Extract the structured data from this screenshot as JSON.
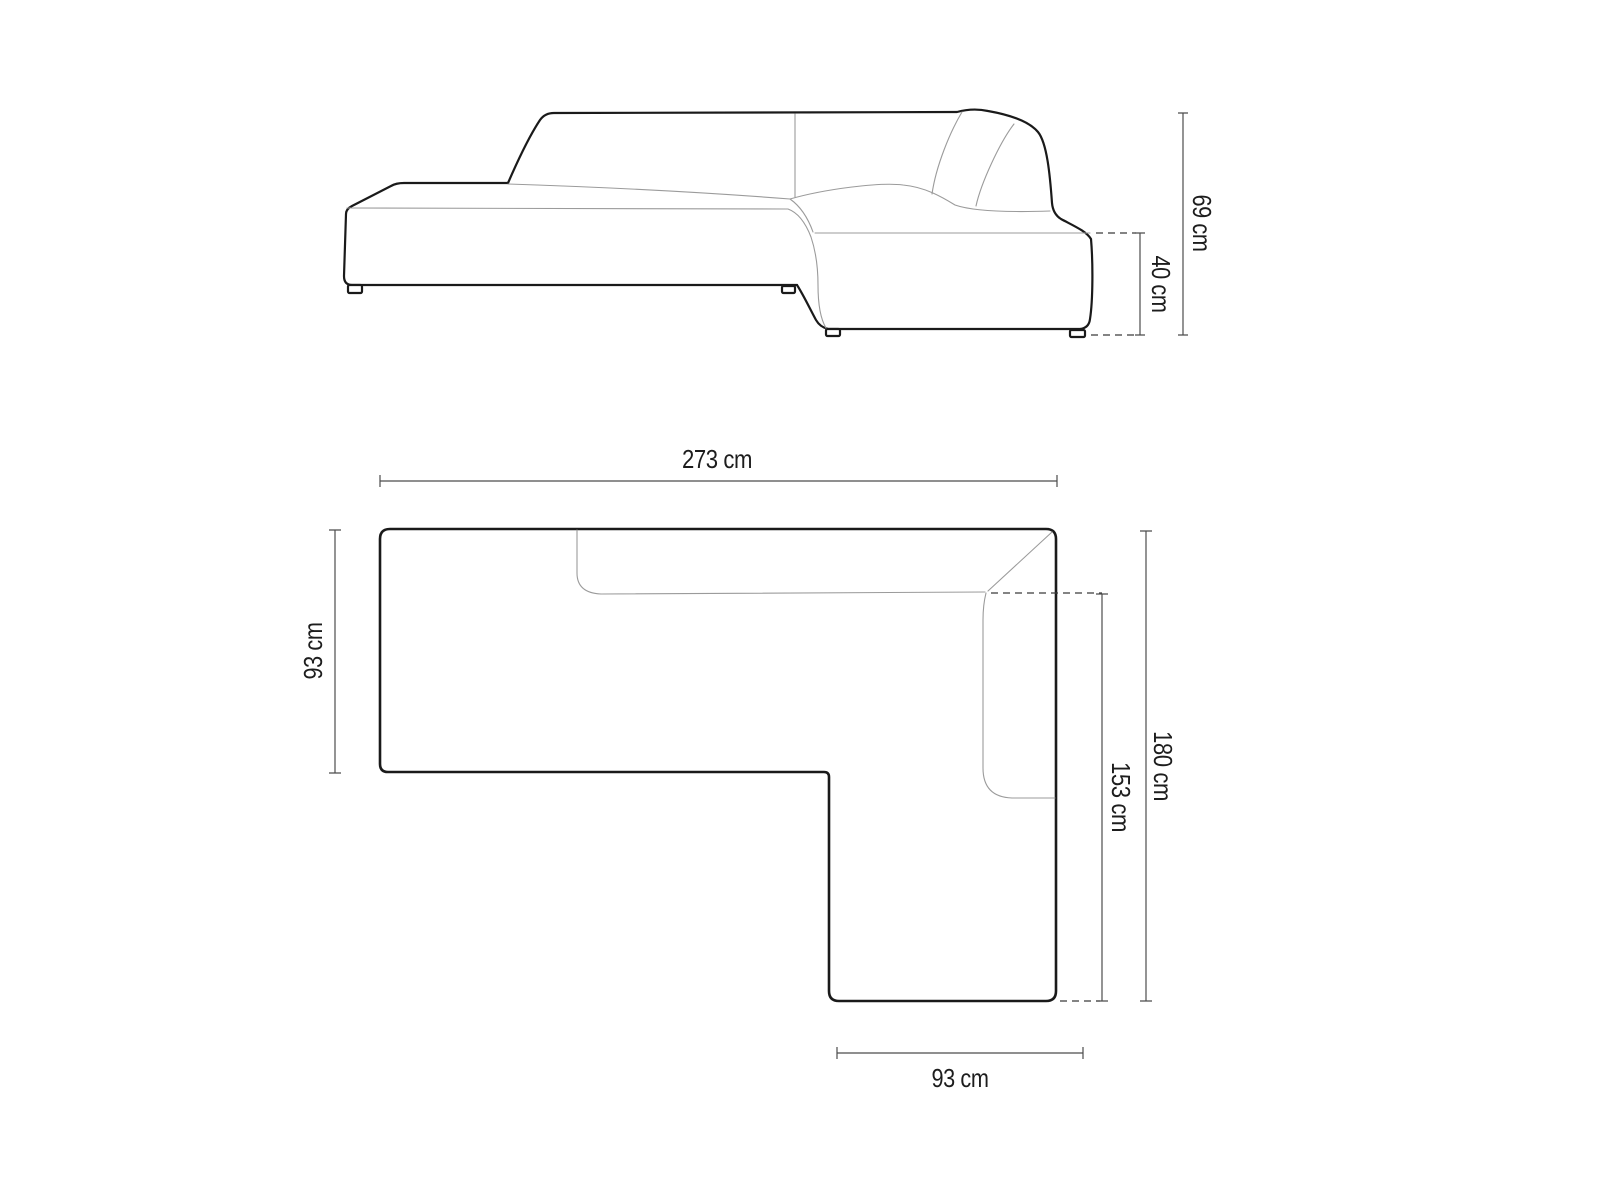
{
  "diagram": {
    "type": "furniture-dimension-drawing",
    "subject": "corner-sofa",
    "unit": "cm",
    "side_view": {
      "total_height_label": "69 cm",
      "seat_height_label": "40 cm",
      "total_height_value": 69,
      "seat_height_value": 40
    },
    "top_view": {
      "total_width_label": "273 cm",
      "left_depth_label": "93 cm",
      "total_depth_label": "180 cm",
      "chaise_inner_length_label": "153 cm",
      "chaise_width_label": "93 cm",
      "total_width_value": 273,
      "left_depth_value": 93,
      "total_depth_value": 180,
      "chaise_inner_length_value": 153,
      "chaise_width_value": 93
    },
    "colors": {
      "background": "#ffffff",
      "outline": "#1a1a1a",
      "interior_line": "#9b9b9b",
      "dimension_line": "#4c4c4c",
      "dashed_line": "#3a3a3a",
      "text": "#1d1d1d"
    }
  }
}
